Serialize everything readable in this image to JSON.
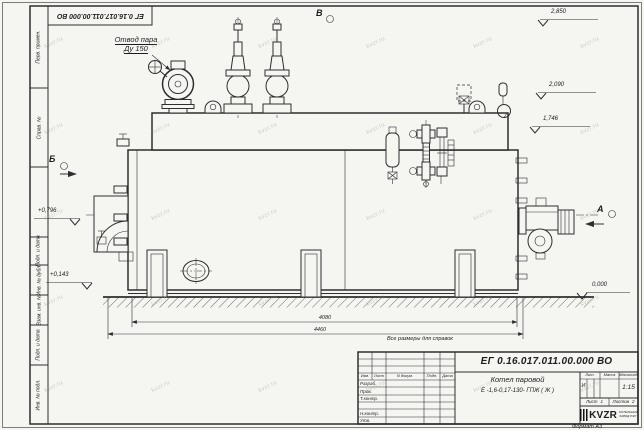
{
  "drawing": {
    "stamp_rotated": "ЕГ 0.16.017.011.00.000  ВО",
    "callout_steam_line1": "Отвод пара",
    "callout_steam_line2": "Ду 150",
    "view_b": "Б",
    "view_v": "В",
    "view_a": "А",
    "elev_2850": "2,850",
    "elev_2090": "2,090",
    "elev_1746": "1,746",
    "elev_0796": "+0,796",
    "elev_0143": "+0,143",
    "elev_0000": "0,000",
    "dim_4080": "4080",
    "dim_4460": "4460",
    "note_reference": "Все размеры для справок"
  },
  "frame": {
    "col1": "Перв. примен.",
    "col2": "Справ. №",
    "col3": "Подп. и дата",
    "col4": "Инв. № дубл.",
    "col5": "Взам. инв. №",
    "col6": "Подп. и дата",
    "col7": "Инв. № подл.",
    "format_note": "Формат А3"
  },
  "title_block": {
    "doc_number": "ЕГ 0.16.017.011.00.000  ВО",
    "product_name": "Котел паровой",
    "product_code": "Е -1,6-0,17-130- ГПЖ ( Ж )",
    "h_izm": "Изм.",
    "h_list": "Лист",
    "h_doc": "N докум.",
    "h_podp": "Подп.",
    "h_data": "Дата",
    "r1": "Разраб.",
    "r2": "Пров.",
    "r3": "Т.контр.",
    "r4": "Н.контр.",
    "r5": "Утв.",
    "h_lit": "Лит.",
    "h_mass": "Масса",
    "h_scale": "Масштаб",
    "lit_value": "И",
    "scale_value": "1:15",
    "sheet_label": "Лист",
    "sheet_value": "1",
    "sheets_label": "Листов",
    "sheets_value": "2",
    "logo_text": "KVZR",
    "logo_sub1": "КОТЕЛЬНЫЙ",
    "logo_sub2": "ЗАВОД РЭП"
  },
  "watermark": {
    "text": "kvzr.ru"
  }
}
